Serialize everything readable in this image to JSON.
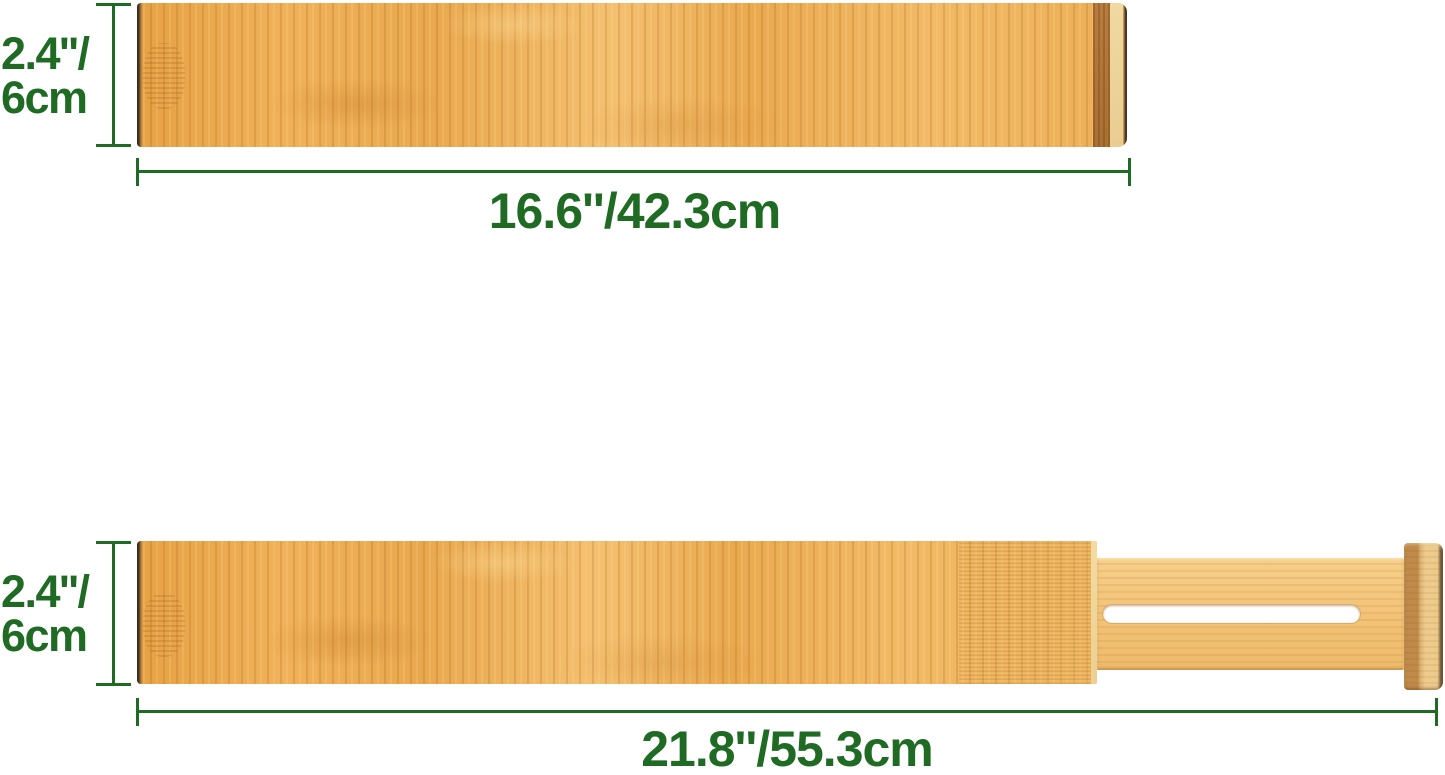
{
  "diagram": {
    "background_color": "#ffffff",
    "accent_color": "#1f6b24",
    "wood_base_color": "#edb05a",
    "wood_light_color": "#f4c87e",
    "wood_dark_stripe_color": "#b3773a",
    "top_figure": {
      "height_label_line1": "2.4''/",
      "height_label_line2": "6cm",
      "width_label": "16.6''/42.3cm"
    },
    "bottom_figure": {
      "height_label_line1": "2.4''/",
      "height_label_line2": "6cm",
      "width_label": "21.8''/55.3cm"
    }
  }
}
